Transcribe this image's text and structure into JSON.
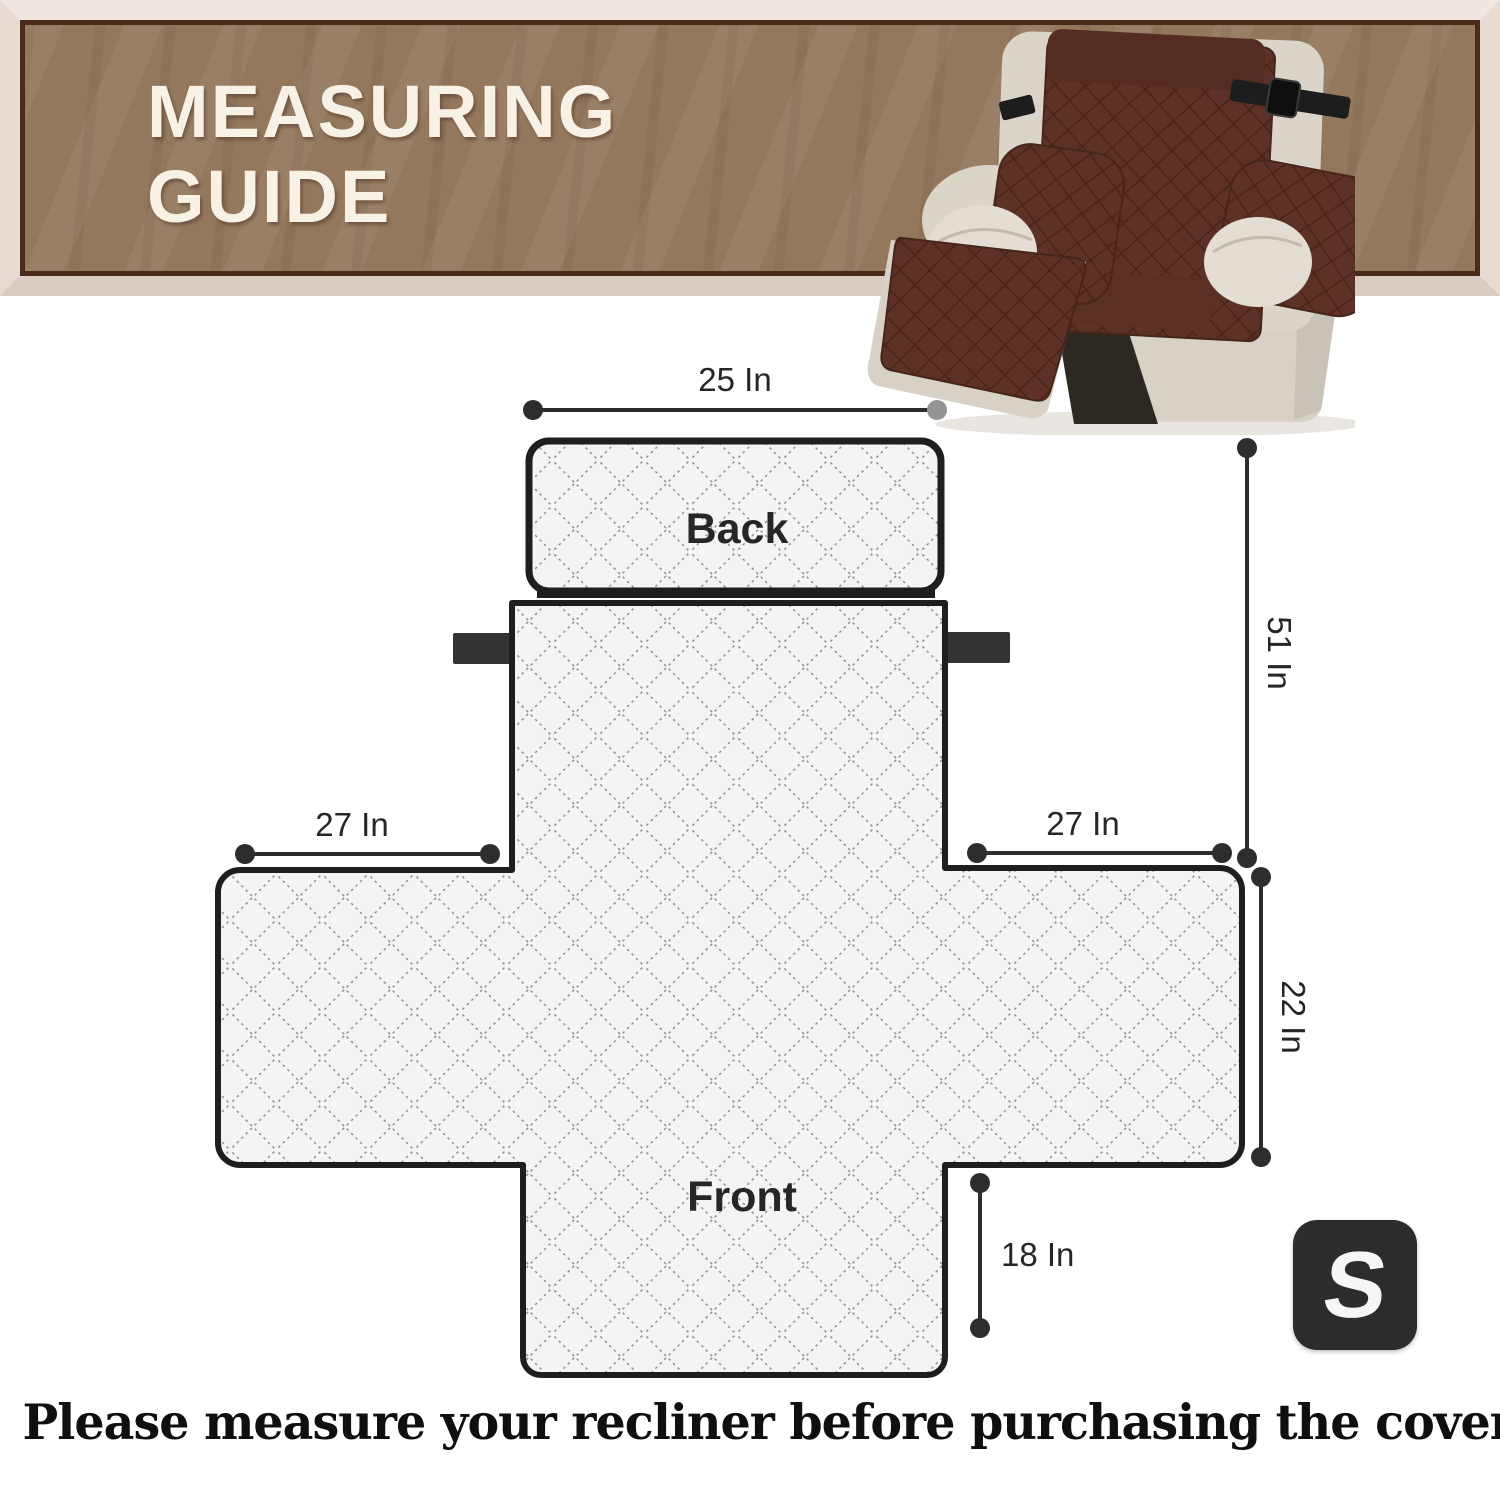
{
  "header": {
    "title_line1": "MEASURING",
    "title_line2": "GUIDE"
  },
  "diagram": {
    "back_label": "Back",
    "front_label": "Front",
    "dim_back_width": "25 In",
    "dim_left_arm": "27 In",
    "dim_right_arm": "27 In",
    "dim_total_length": "51 In",
    "dim_seat_depth": "22 In",
    "dim_front_drop": "18 In"
  },
  "product": {
    "size_badge": "S"
  },
  "footer": {
    "note": "Please measure your recliner before purchasing the cover"
  },
  "colors": {
    "banner_brown": "#93785e",
    "banner_frame_cream": "#e9ded6",
    "banner_inner_border": "#4a2b1a",
    "cover_brown": "#5d3126",
    "chair_beige": "#dad4c9",
    "diagram_fill": "#f4f4f4",
    "diagram_line": "#8a8a8a",
    "outline_dark": "#1e1e1e",
    "badge_black": "#2d2c2c"
  }
}
